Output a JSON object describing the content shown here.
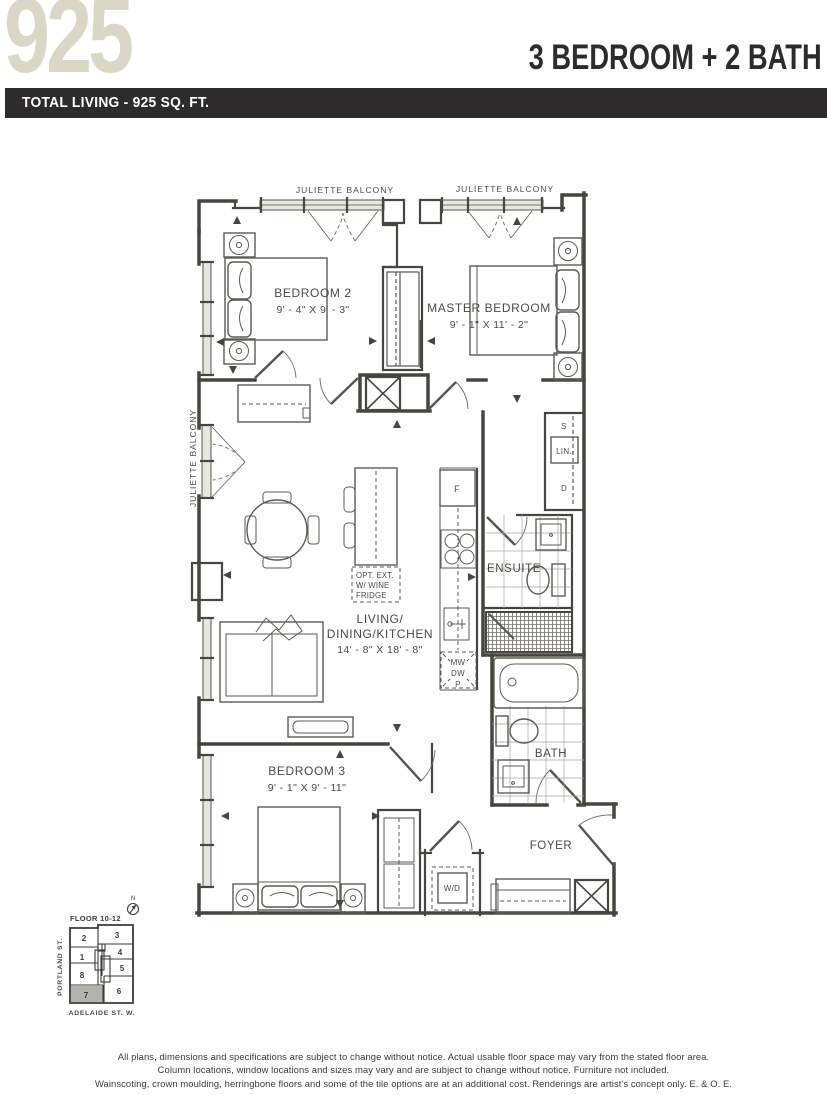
{
  "header": {
    "unit_number": "925",
    "unit_type": "3 BEDROOM + 2 BATH",
    "total_living": "TOTAL LIVING - 925 SQ. FT."
  },
  "colors": {
    "accent_beige": "#DBD7C6",
    "bar_dark": "#2D2B2C",
    "plan_line": "#46453F",
    "keyplan_highlight": "#B4B2AE"
  },
  "plan": {
    "balcony_label": "JULIETTE BALCONY",
    "rooms": {
      "bedroom2": {
        "name": "BEDROOM 2",
        "dims": "9' - 4\" X 9' - 3\""
      },
      "master": {
        "name": "MASTER BEDROOM",
        "dims": "9' - 1\" X 11' - 2\""
      },
      "living": {
        "name_line1": "LIVING/",
        "name_line2": "DINING/KITCHEN",
        "dims": "14' - 8\" X 18' - 8\""
      },
      "bedroom3": {
        "name": "BEDROOM 3",
        "dims": "9' - 1\" X 9' - 11\""
      },
      "ensuite": "ENSUITE",
      "bath": "BATH",
      "foyer": "FOYER"
    },
    "labels": {
      "fridge": "F",
      "microwave": "MW",
      "dishwasher": "DW",
      "pantry": "P",
      "washer_dryer": "W/D",
      "shelf": "S",
      "linen": "LIN.",
      "drawers": "D",
      "opt_line1": "OPT. EXT.",
      "opt_line2": "W/ WINE",
      "opt_line3": "FRIDGE"
    }
  },
  "keyplan": {
    "floor_label": "FLOOR 10-12",
    "north": "N",
    "street_left": "PORTLAND ST.",
    "street_bottom": "ADELAIDE ST. W.",
    "units": [
      "1",
      "2",
      "3",
      "4",
      "5",
      "6",
      "7",
      "8"
    ],
    "highlighted_unit": "7"
  },
  "disclaimer": {
    "line1": "All plans, dimensions and specifications are subject to change without notice. Actual usable floor space may vary from the stated floor area.",
    "line2": "Column locations, window locations and sizes may vary and are subject to change without notice. Furniture not included.",
    "line3": "Wainscoting, crown moulding, herringbone floors and some of the tile options are at an additional cost. Renderings are artist's concept only. E. & O. E."
  }
}
